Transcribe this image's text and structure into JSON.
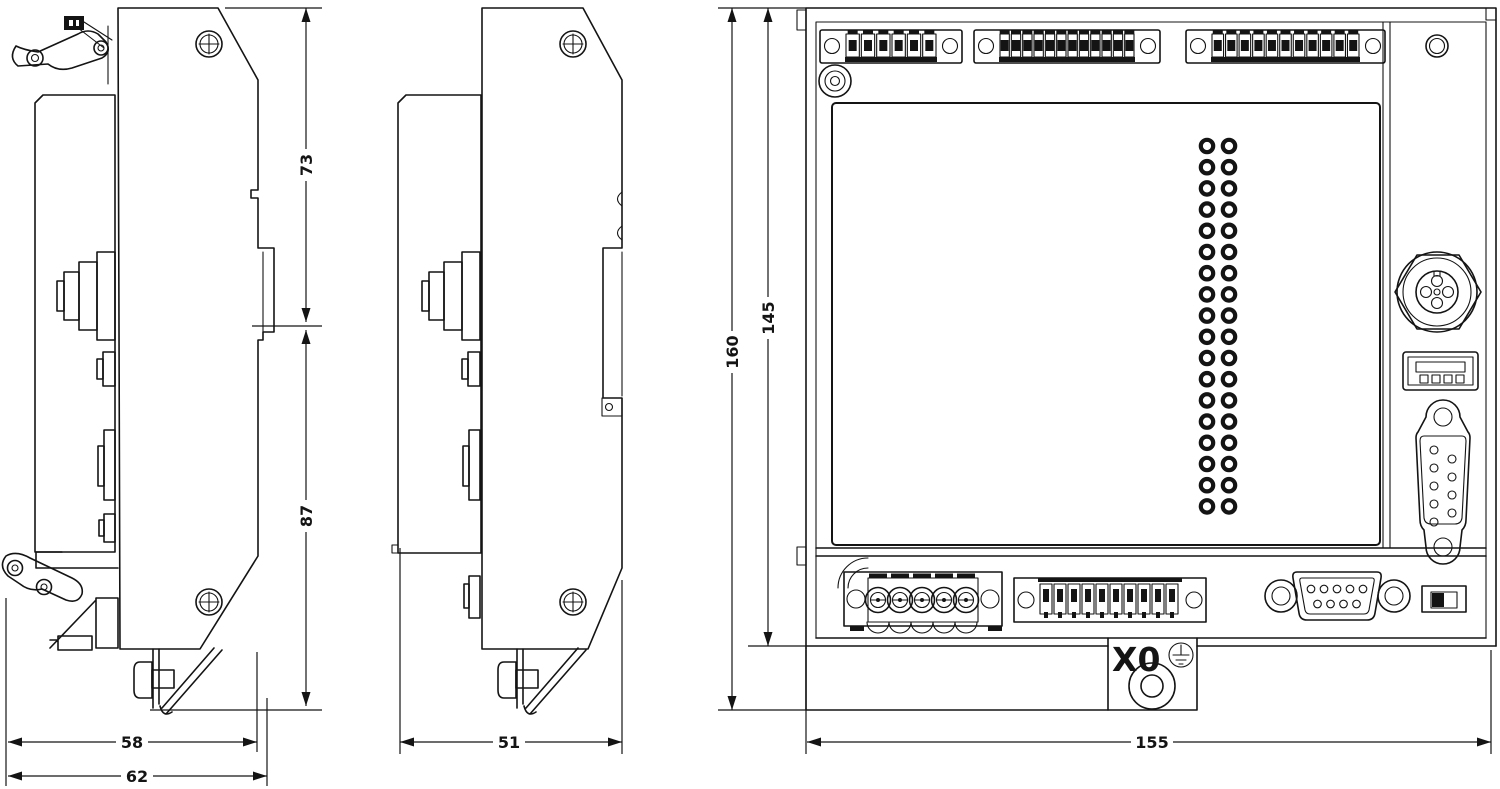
{
  "drawing": {
    "colors": {
      "line": "#141414",
      "background": "#ffffff"
    },
    "views": [
      {
        "id": "side-view-with-clips",
        "name": "side view with DIN-rail clips"
      },
      {
        "id": "side-view-plain",
        "name": "side view plain"
      },
      {
        "id": "front-view",
        "name": "front view"
      }
    ],
    "dimensions": {
      "d73": "73",
      "d87": "87",
      "d58": "58",
      "d62": "62",
      "d51": "51",
      "d160": "160",
      "d145": "145",
      "d155": "155"
    },
    "labels": {
      "x0": "X0"
    },
    "front": {
      "top_terminal_blocks": [
        {
          "clamps": 6
        },
        {
          "clamps": 12
        },
        {
          "clamps": 11
        }
      ],
      "power_terminals": 5,
      "bottom_small_block_clamps": 10,
      "vent_rows": 18,
      "vent_cols": 2,
      "db9_pins": 9,
      "usb_contacts": 4,
      "m12_pins": 5
    }
  }
}
